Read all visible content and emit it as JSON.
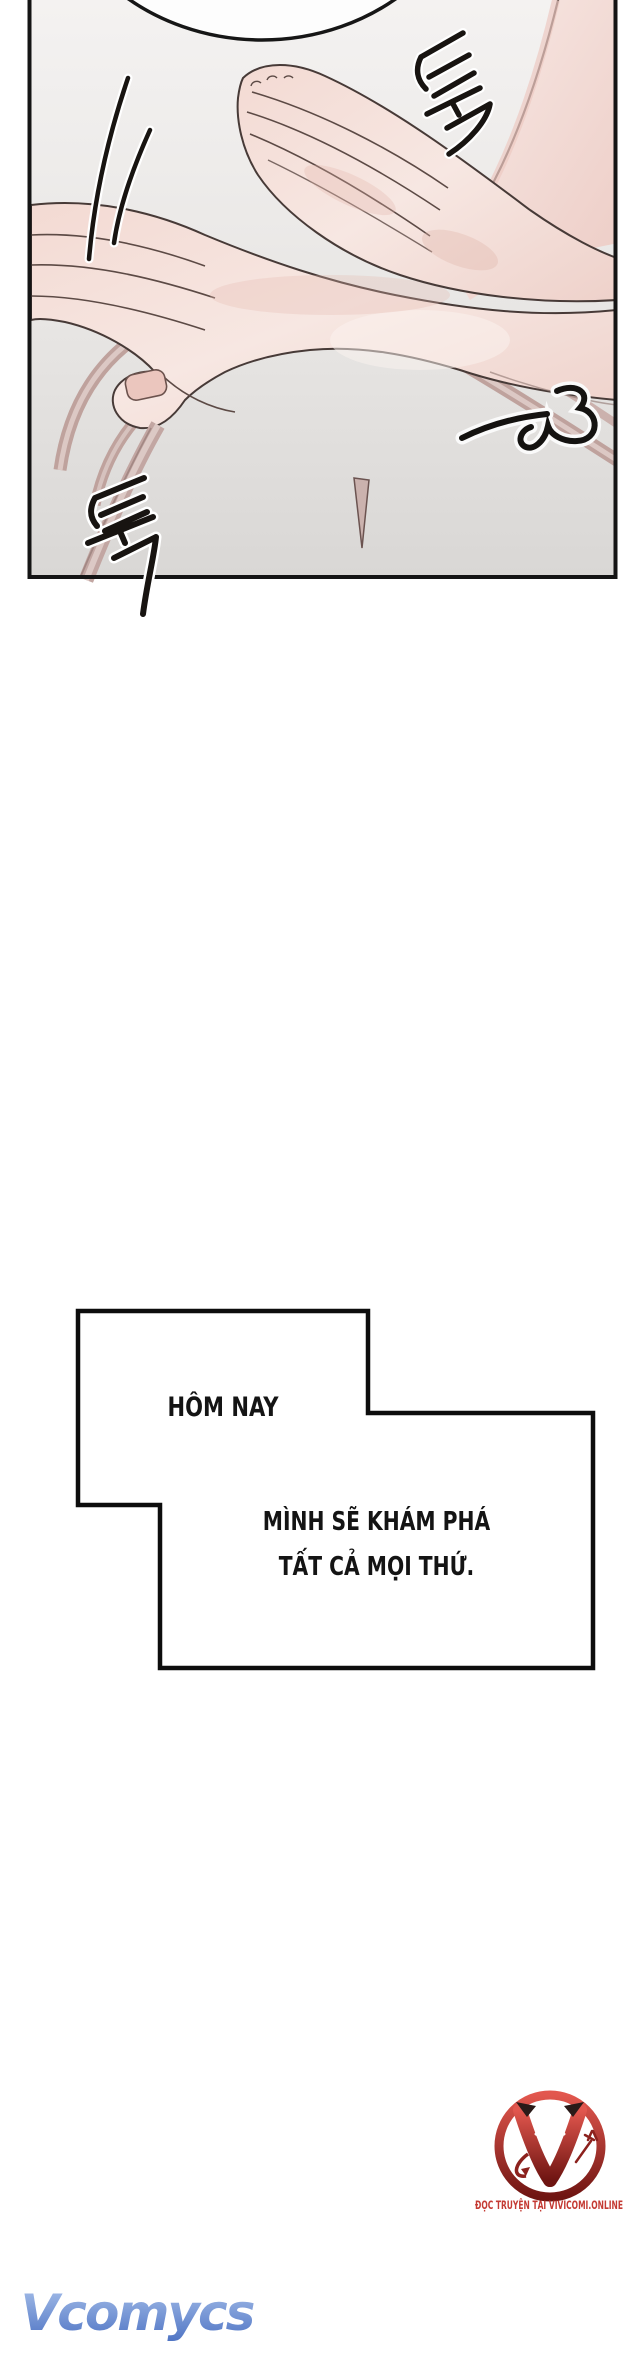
{
  "page": {
    "width": 640,
    "height": 2360,
    "background": "#ffffff"
  },
  "panel": {
    "kind": "comic-panel",
    "border_color": "#141414",
    "background_top": "#f4f2f1",
    "background_bottom": "#d9d7d5",
    "artwork_description": "two pale hands touching over a pink camisole strap, empty speech bubble cropped at top",
    "sfx_top_right": {
      "text": "툭",
      "romanized": "tuk",
      "style": "hand-drawn korean sound effect, rotated"
    },
    "sfx_bottom_left": {
      "text": "툭",
      "romanized": "tuk",
      "style": "hand-drawn korean sound effect, rotated, long tail crossing panel border"
    },
    "heart_doodle": {
      "description": "sideways heart / 3-shaped squiggle with motion dash"
    }
  },
  "caption": {
    "line1": "HÔM NAY",
    "line2": "MÌNH SẼ KHÁM PHÁ",
    "line3": "TẤT CẢ MỌI THỨ.",
    "text_color": "#141414",
    "box_fill": "#ffffff",
    "box_border": "#0d0d0d"
  },
  "watermarks": {
    "vcomycs": {
      "text": "Vcomycs",
      "color_top": "#a7c0ea",
      "color_bottom": "#4f74c4"
    },
    "vivicomi": {
      "tagline": "ĐỌC TRUYỆN TẠI VIVICOMI.ONLINE",
      "tagline_color": "#c43a33",
      "ring_color_top": "#e2574e",
      "ring_color_bottom": "#6f1512"
    }
  }
}
